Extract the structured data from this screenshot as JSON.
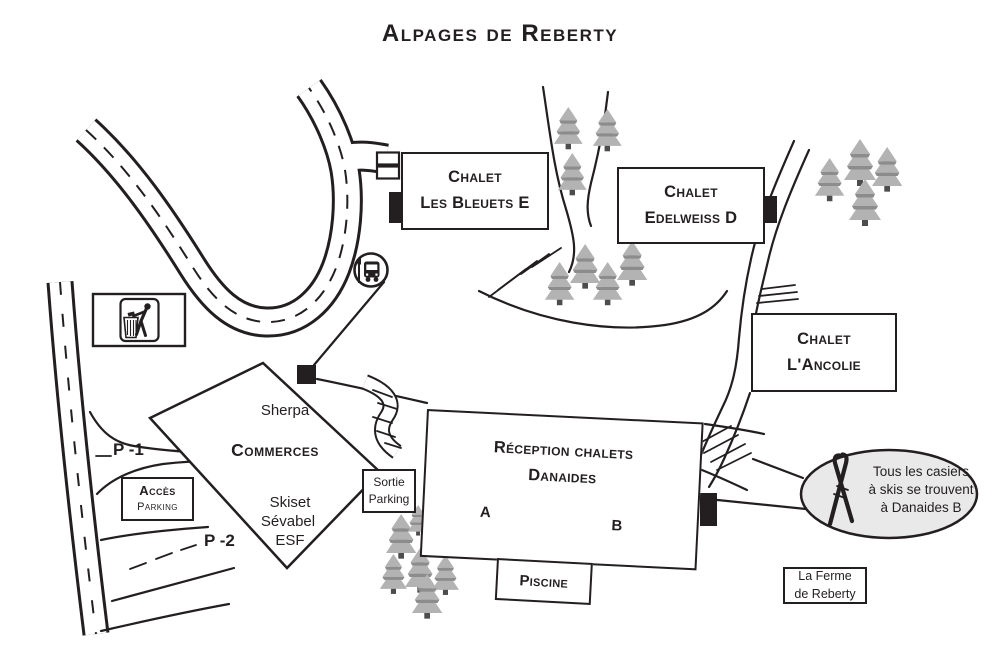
{
  "title": "Alpages de Reberty",
  "chalets": {
    "bleuets": {
      "line1": "Chalet",
      "line2": "Les Bleuets E"
    },
    "edelweiss": {
      "line1": "Chalet",
      "line2": "Edelweiss D"
    },
    "ancolie": {
      "line1": "Chalet",
      "line2": "L'Ancolie"
    }
  },
  "reception": {
    "line1": "Réception chalets",
    "line2": "Danaides",
    "unit_a": "A",
    "unit_b": "B"
  },
  "piscine": {
    "label": "Piscine"
  },
  "ferme": {
    "line1": "La Ferme",
    "line2": "de Reberty"
  },
  "commerces": {
    "shop1": "Sherpa",
    "heading": "Commerces",
    "shop2": "Skiset",
    "shop3": "Sévabel",
    "shop4": "ESF"
  },
  "parking": {
    "acces_line1": "Accès",
    "acces_line2": "Parking",
    "sortie_line1": "Sortie",
    "sortie_line2": "Parking",
    "level1": "P -1",
    "level2": "P -2"
  },
  "bubble": {
    "line1": "Tous les casiers",
    "line2": "à skis se trouvent",
    "line3": "à Danaides B"
  },
  "icons": {
    "bus_stop": "bus-stop-icon",
    "litter": "litter-disposal-icon",
    "skis": "crossed-skis-icon",
    "tree": "pine-tree-icon"
  },
  "colors": {
    "ink": "#231f20",
    "tree_fill": "#b3b3b3",
    "tree_shadow": "#8c8c8c",
    "trunk": "#4d4d4d",
    "bubble_fill": "#e9e9e9",
    "background": "#ffffff"
  }
}
